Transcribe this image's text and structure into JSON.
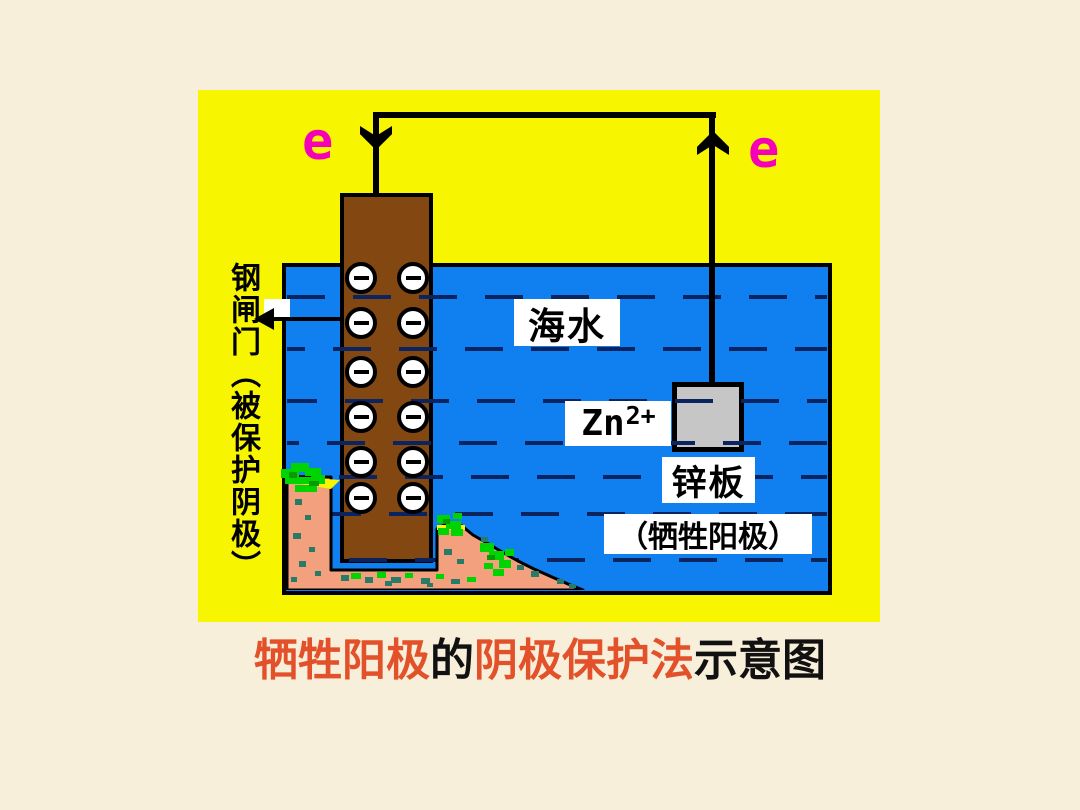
{
  "slide": {
    "caption": {
      "seg1": "牺牲阳极",
      "seg2": "的",
      "seg3": "阴极保护法",
      "seg4": "示意图"
    },
    "labels": {
      "seawater": "海水",
      "zinc_ion_base": "Zn",
      "zinc_ion_charge": "2+",
      "zinc_plate": "锌板",
      "zinc_plate_role": "（牺牲阳极）",
      "steel_gate": "钢闸门（被保护阴极）",
      "electron_left": "e",
      "electron_right": "e"
    },
    "electrons": {
      "rows": 6,
      "cols": 2,
      "count": 12,
      "symbol": "−"
    },
    "colors": {
      "slide_bg": "#f8efda",
      "panel_yellow": "#f7f500",
      "water_blue": "#107ff0",
      "wave_navy": "#0a2460",
      "electrode_brown": "#834712",
      "zinc_gray": "#c6c6c6",
      "seabed_salmon": "#f2a07e",
      "algae_green": "#00d400",
      "algae_teal": "#2a7a68",
      "electron_magenta": "#f500b8",
      "caption_red": "#e2512a",
      "line_black": "#000000"
    }
  }
}
